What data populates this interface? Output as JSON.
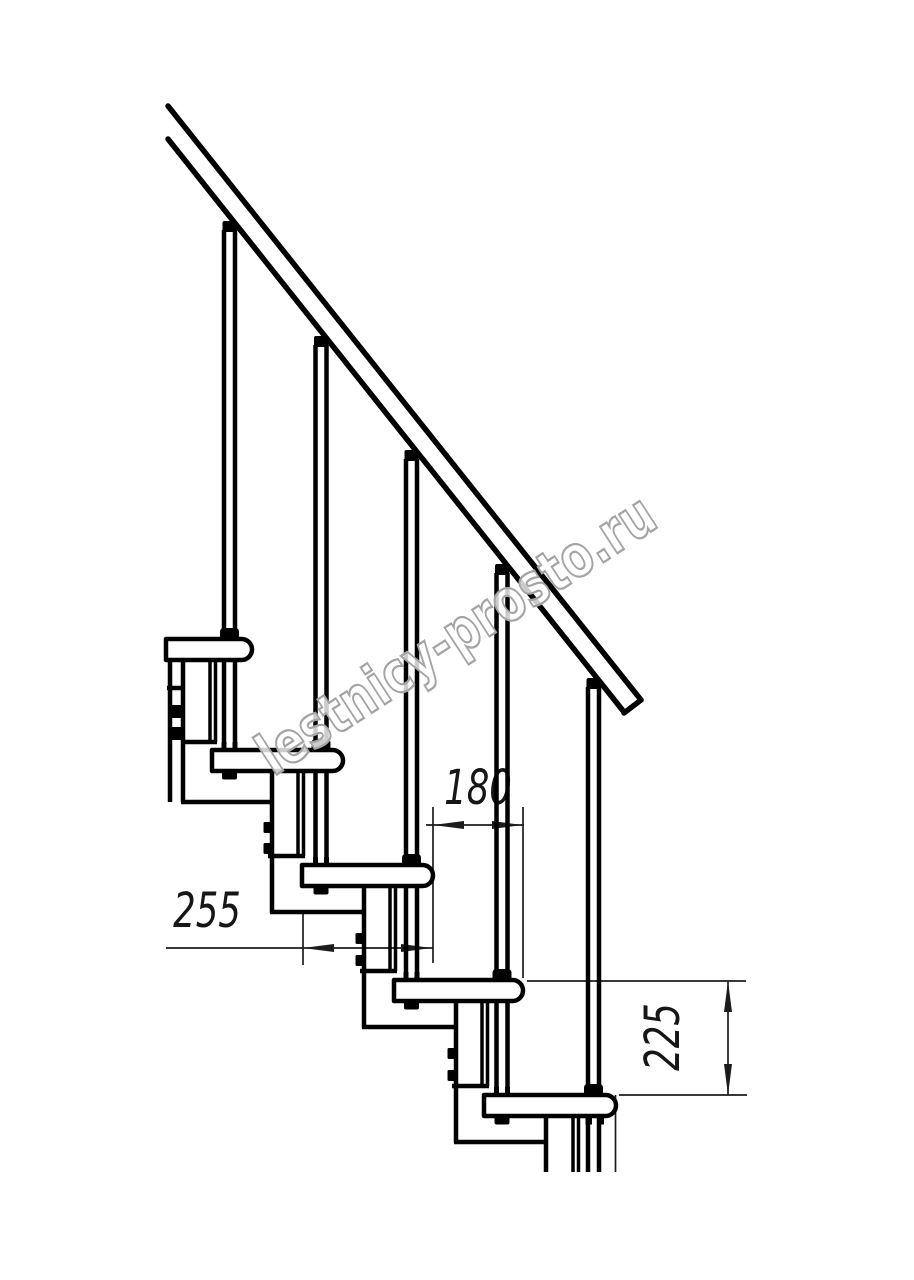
{
  "canvas": {
    "width": 914,
    "height": 1280,
    "background": "#ffffff"
  },
  "watermark": {
    "text": "lestnicy-prosto.ru",
    "outline_color": "#a4a4a4"
  },
  "dimensions": {
    "tread_depth": "255",
    "step_run": "180",
    "riser_height": "225"
  },
  "colors": {
    "line": "#000000",
    "dimension_line": "#1c1c1c"
  }
}
